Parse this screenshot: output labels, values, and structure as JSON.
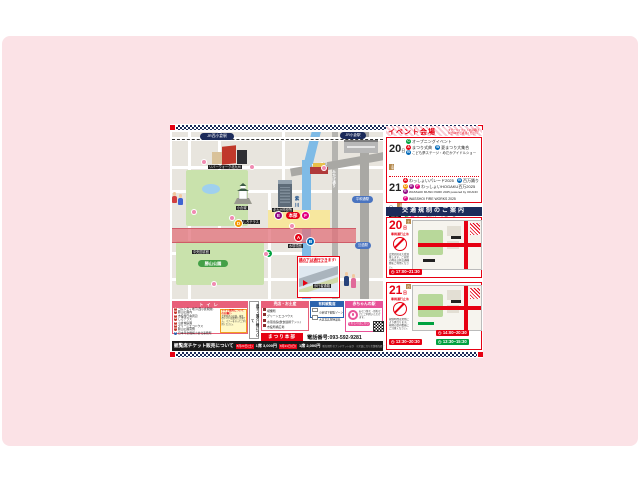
{
  "icons": {
    "clock": "◷"
  },
  "letter_colors": {
    "A": "#e60012",
    "B": "#0068b7",
    "C": "#00a23f",
    "D": "#f39800",
    "E": "#920783",
    "F": "#e4007f"
  },
  "map": {
    "stations": {
      "nishi_kokura": "JR西小倉駅",
      "kokura": "JR小倉駅",
      "heiwadori": "平和通駅",
      "tanga": "旦過駅"
    },
    "streets": {
      "katsuyama": "勝山通り",
      "mikage": "みかげ通り",
      "river": "紫川"
    },
    "labels": [
      "リバーウォーク北九州",
      "小倉城",
      "北九州市役所",
      "中央図書館",
      "水環境館",
      "しろテラス"
    ],
    "park_label": "勝山公園",
    "hq_label": "本部",
    "markers": [
      "A",
      "B",
      "C",
      "D",
      "E",
      "F"
    ],
    "callout": {
      "title": "橋の下は通行できます!",
      "subtitle": "BRIDGE UNDERPASS OK",
      "path_label": "歩行者通路"
    }
  },
  "event_panel": {
    "title": "イベント会場",
    "note1": "ステージイベントの詳細は",
    "note2": "公式HPをご確認ください",
    "day20": {
      "num": "20",
      "unit": "日",
      "weekday": "土曜"
    },
    "rows20": [
      {
        "c": "C",
        "t": "オープニングイベント"
      },
      {
        "c": "A",
        "t": "まつり式典"
      },
      {
        "c": "B",
        "t": "夏まつり大集合"
      },
      {
        "c": "B",
        "t": "こども夢ステージ・めだかアイドルショー"
      }
    ],
    "day21": {
      "num": "21",
      "unit": "日",
      "weekday": "日曜"
    },
    "rows21": [
      {
        "c": "A",
        "t": "わっしょいパレード2025"
      },
      {
        "c": "B",
        "t": "百万踊り"
      },
      {
        "c": "D",
        "c2": "E",
        "c3": "F",
        "t": "わっしょいHOGAKU百万2025"
      },
      {
        "c": "E",
        "t": "WASSHOI MUSIC PARK 2025 powered by OKANO"
      },
      {
        "c": "F",
        "t": "WASSHOI FIRE WORKS 2025"
      }
    ],
    "both_label": "両日",
    "both": {
      "c": "C",
      "c2": "F",
      "t": "サッポロビールフェス2025"
    },
    "notes": [
      "※イベント内容・時間は変更になる場合があります。",
      "※詳しくは公式ホームページをご覧ください。"
    ]
  },
  "traffic": {
    "header": "交通規制のご案内",
    "day20": {
      "num": "20",
      "unit": "日",
      "weekday": "土",
      "closure": "車両通行止め",
      "note": "会場周辺は大変混雑します。ご来場の際は公共交通機関をご利用ください。",
      "time": "17:00~21:30"
    },
    "day21": {
      "num": "21",
      "unit": "日",
      "weekday": "日",
      "closure": "車両通行止め",
      "note": "規制時間は場所により異なります。現地の案内看板にご注意ください。",
      "time1": "14:00~20:30",
      "time2": "13:30~20:30",
      "time3": "13:30~15:30"
    }
  },
  "legend": {
    "toilets": {
      "header": "トイレ",
      "items": [
        {
          "no": "1",
          "t": "コムシティ地下(西小倉駅前)"
        },
        {
          "no": "2",
          "t": "勝山公園内"
        },
        {
          "no": "3",
          "t": "市役所庁舎周辺"
        },
        {
          "no": "4",
          "t": "しろテラス"
        },
        {
          "no": "5",
          "t": "小倉城庭園"
        },
        {
          "no": "6",
          "t": "グリーンエコハウス"
        },
        {
          "no": "7",
          "t": "勝山公園南側"
        }
      ],
      "extra": {
        "no": "8",
        "t": "日本年金機構小倉北事務所"
      },
      "note_title": "トイレ使用についてのお願い",
      "note_body": "会場周辺の店舗・施設のトイレは使用できません。マナーを守ってご利用ください。"
    },
    "vertical_notice": "迷子・落とし物について",
    "shops": {
      "header": "売店・お土産",
      "items": [
        "喫煙所",
        "グリーンエコハウス",
        "水環境館(飲食連携テント)",
        "市役所横広場"
      ]
    },
    "seats": {
      "header": "有料観覧席",
      "items": [
        "小倉城下観覧ゾーン",
        "大正北広場特設席"
      ]
    },
    "baby": {
      "header": "赤ちゃんの駅",
      "body": "おむつ替え・授乳などにご利用いただけます。",
      "button": "くわしくはこちら"
    },
    "hq": {
      "label": "まつり本部",
      "phone": "電話番号:093-592-9281"
    }
  },
  "ticket_bar": {
    "label": "観覧席チケット販売について",
    "date1": "8月20日(土)",
    "price1": "1席 3,000円",
    "date2": "8月21日(日)",
    "price2": "1席 2,000円",
    "note1": "販売場所:セブンチケットほか",
    "note2": "※定員になり次第販売終了"
  }
}
